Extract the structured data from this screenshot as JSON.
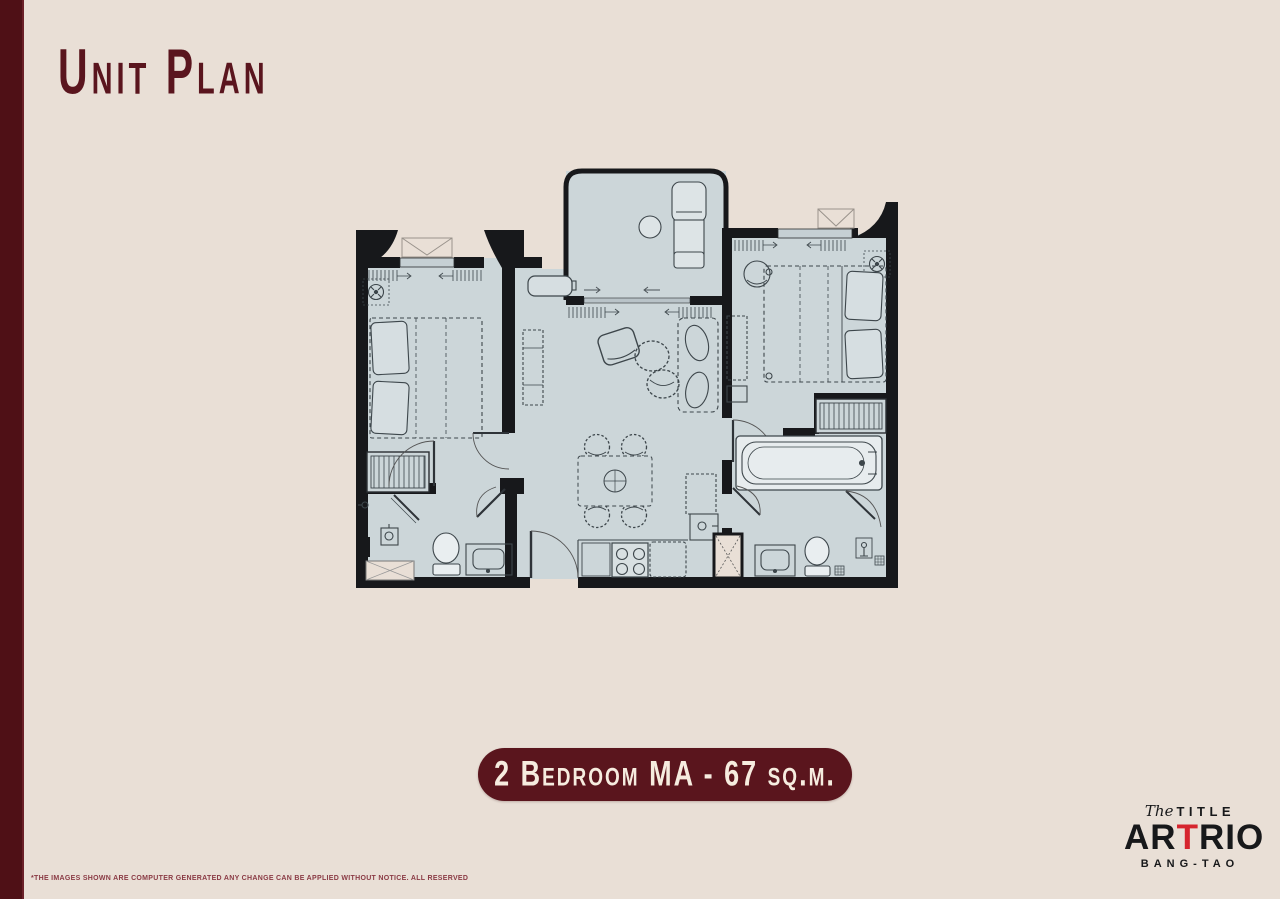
{
  "page": {
    "title": "Unit Plan"
  },
  "badge": {
    "label": "2 Bedroom MA - 67 sq.m."
  },
  "logo": {
    "script_word": "The",
    "brand": "TITLE",
    "project_pre": "AR",
    "project_accent": "T",
    "project_post": "RIO",
    "location": "BANG-TAO"
  },
  "footer": {
    "disclaimer": "*THE IMAGES SHOWN ARE COMPUTER GENERATED ANY CHANGE CAN BE APPLIED WITHOUT NOTICE. ALL RESERVED"
  },
  "colors": {
    "background": "#e9dfd6",
    "accent_maroon": "#4f1016",
    "badge_maroon": "#5a151d",
    "title_maroon": "#5a151e",
    "floor": "#ccd6d9",
    "wall": "#17181b",
    "logo_red": "#d6252e",
    "badge_text_cream": "#f6ecdf"
  }
}
